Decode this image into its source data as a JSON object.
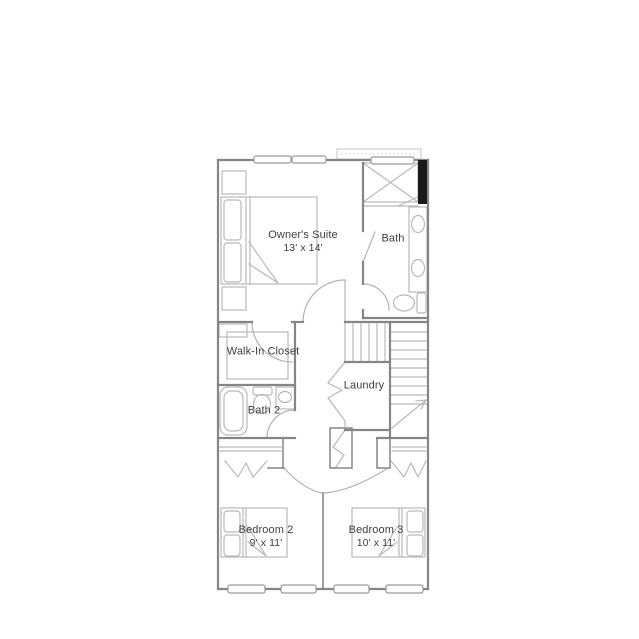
{
  "plan": {
    "kind": "residential-floor-plan",
    "background": "#ffffff",
    "colors": {
      "wall": "#868686",
      "accent_wall": "#1a1a1a",
      "fixture": "#b9b9b9",
      "light_detail": "#cfcfcf",
      "text": "#3f3f3f"
    },
    "rooms": [
      {
        "key": "owners_suite",
        "name": "Owner's Suite",
        "dims": "13' x 14'"
      },
      {
        "key": "bath",
        "name": "Bath"
      },
      {
        "key": "walk_in_closet",
        "name": "Walk-In Closet"
      },
      {
        "key": "bath_2",
        "name": "Bath 2"
      },
      {
        "key": "laundry",
        "name": "Laundry"
      },
      {
        "key": "bedroom_2",
        "name": "Bedroom 2",
        "dims": "9' x 11'"
      },
      {
        "key": "bedroom_3",
        "name": "Bedroom 3",
        "dims": "10' x 11'"
      }
    ],
    "fixtures": [
      "bed-owners-suite",
      "nightstand",
      "nightstand",
      "shower",
      "double-sink-vanity",
      "toilet",
      "bathtub",
      "toilet",
      "sink-vanity",
      "closet-shelving",
      "stairs-with-direction-arrow",
      "bifold-doors-laundry",
      "bifold-doors-bedroom-2-closet",
      "bifold-doors-bedroom-3-closet",
      "bed-bedroom-2",
      "bed-bedroom-3",
      "window",
      "window",
      "window",
      "window",
      "window",
      "window",
      "window"
    ]
  }
}
